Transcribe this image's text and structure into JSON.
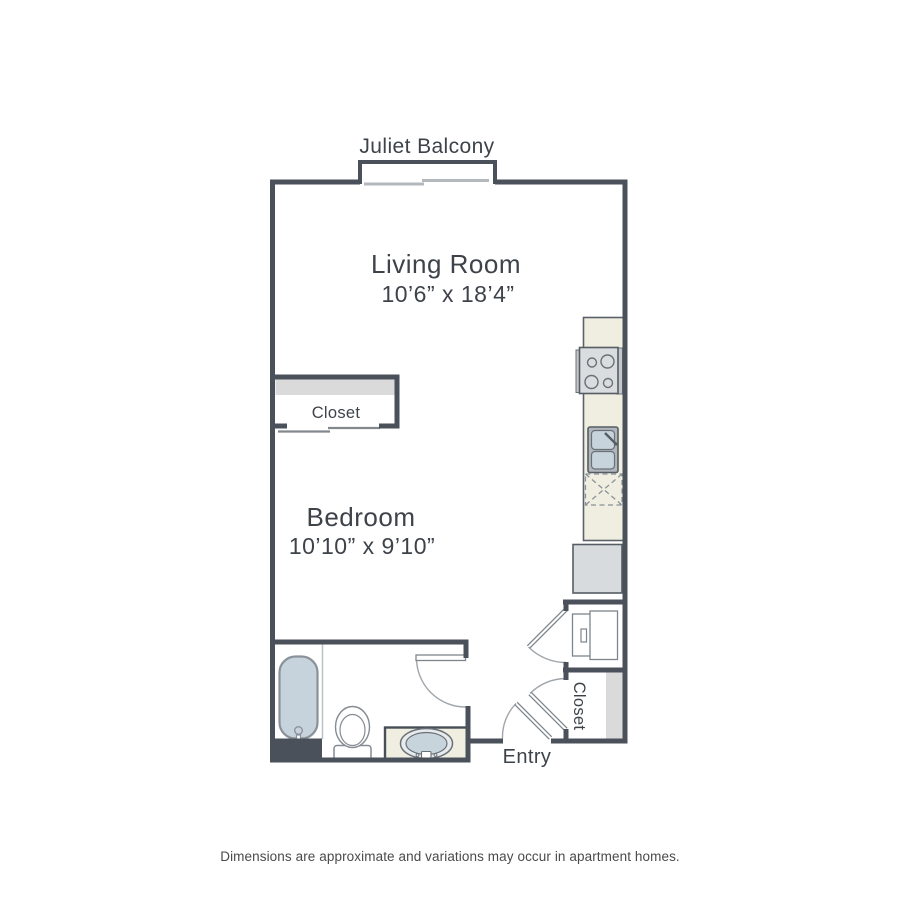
{
  "plan": {
    "balcony_label": "Juliet Balcony",
    "living_room": {
      "name": "Living Room",
      "dims": "10’6” x 18’4”"
    },
    "bedroom": {
      "name": "Bedroom",
      "dims": "10’10” x 9’10”"
    },
    "bedroom_closet_label": "Closet",
    "entry_closet_label": "Closet",
    "entry_label": "Entry"
  },
  "footer": {
    "disclaimer": "Dimensions are approximate and variations may occur in apartment homes."
  },
  "colors": {
    "wall": "#4a515a",
    "counter_beige": "#efeee1",
    "tub_blue": "#c7d3dc",
    "basin_blue": "#c8d4dc",
    "shelf_gray": "#dadada",
    "appliance_gray": "#d8dbde",
    "fixture_outline": "#7e858c",
    "door_arc": "#a0a6ab",
    "text": "#3e434a"
  },
  "fixtures": {
    "kitchen": [
      "stove-icon",
      "kitchen-sink-icon",
      "dishwasher-icon",
      "refrigerator-icon"
    ],
    "bathroom": [
      "bathtub-icon",
      "toilet-icon",
      "vanity-sink-icon"
    ],
    "laundry": [
      "washer-dryer-icon"
    ]
  }
}
